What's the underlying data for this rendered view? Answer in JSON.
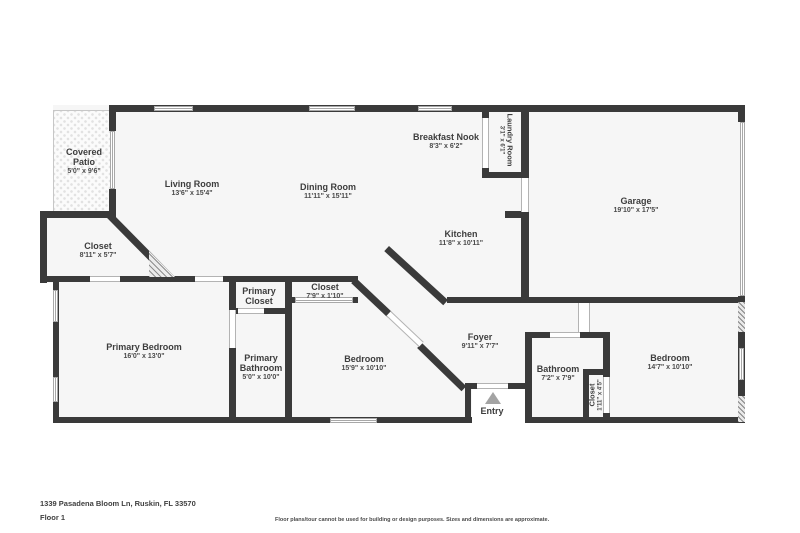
{
  "meta": {
    "address": "1339 Pasadena Bloom Ln, Ruskin, FL 33570",
    "floor_label": "Floor 1",
    "disclaimer": "Floor plans/tour cannot be used for building or design purposes. Sizes and dimensions are approximate."
  },
  "colors": {
    "wall": "#3a3a3a",
    "room_fill": "#f6f6f6",
    "label_text": "#3d3d3d",
    "dims_text": "#4a4a4a",
    "window_line": "#a8a8a8",
    "entry_arrow": "#a3a3a3"
  },
  "rooms": [
    {
      "id": "covered-patio",
      "name": "Covered Patio",
      "dims": "5'0\" x 9'6\""
    },
    {
      "id": "living-room",
      "name": "Living Room",
      "dims": "13'6\" x 15'4\""
    },
    {
      "id": "dining-room",
      "name": "Dining Room",
      "dims": "11'11\" x 15'11\""
    },
    {
      "id": "breakfast-nook",
      "name": "Breakfast Nook",
      "dims": "8'3\" x 6'2\""
    },
    {
      "id": "laundry-room",
      "name": "Laundry Room",
      "dims": "3'1\" x 6'1\""
    },
    {
      "id": "garage",
      "name": "Garage",
      "dims": "19'10\" x 17'5\""
    },
    {
      "id": "closet-hall",
      "name": "Closet",
      "dims": "8'11\" x 5'7\""
    },
    {
      "id": "kitchen",
      "name": "Kitchen",
      "dims": "11'8\" x 10'11\""
    },
    {
      "id": "closet-bedroom",
      "name": "Closet",
      "dims": "7'9\" x 1'10\""
    },
    {
      "id": "primary-closet",
      "name": "Primary Closet",
      "dims": ""
    },
    {
      "id": "primary-bathroom",
      "name": "Primary Bathroom",
      "dims": "5'0\" x 10'0\""
    },
    {
      "id": "primary-bedroom",
      "name": "Primary Bedroom",
      "dims": "16'0\" x 13'0\""
    },
    {
      "id": "bedroom-2",
      "name": "Bedroom",
      "dims": "15'9\" x 10'10\""
    },
    {
      "id": "foyer",
      "name": "Foyer",
      "dims": "9'11\" x 7'7\""
    },
    {
      "id": "bathroom",
      "name": "Bathroom",
      "dims": "7'2\" x 7'9\""
    },
    {
      "id": "closet-small",
      "name": "Closet",
      "dims": "1'11\" x 4'5\""
    },
    {
      "id": "bedroom-3",
      "name": "Bedroom",
      "dims": "14'7\" x 10'10\""
    },
    {
      "id": "entry",
      "name": "Entry",
      "dims": ""
    }
  ]
}
